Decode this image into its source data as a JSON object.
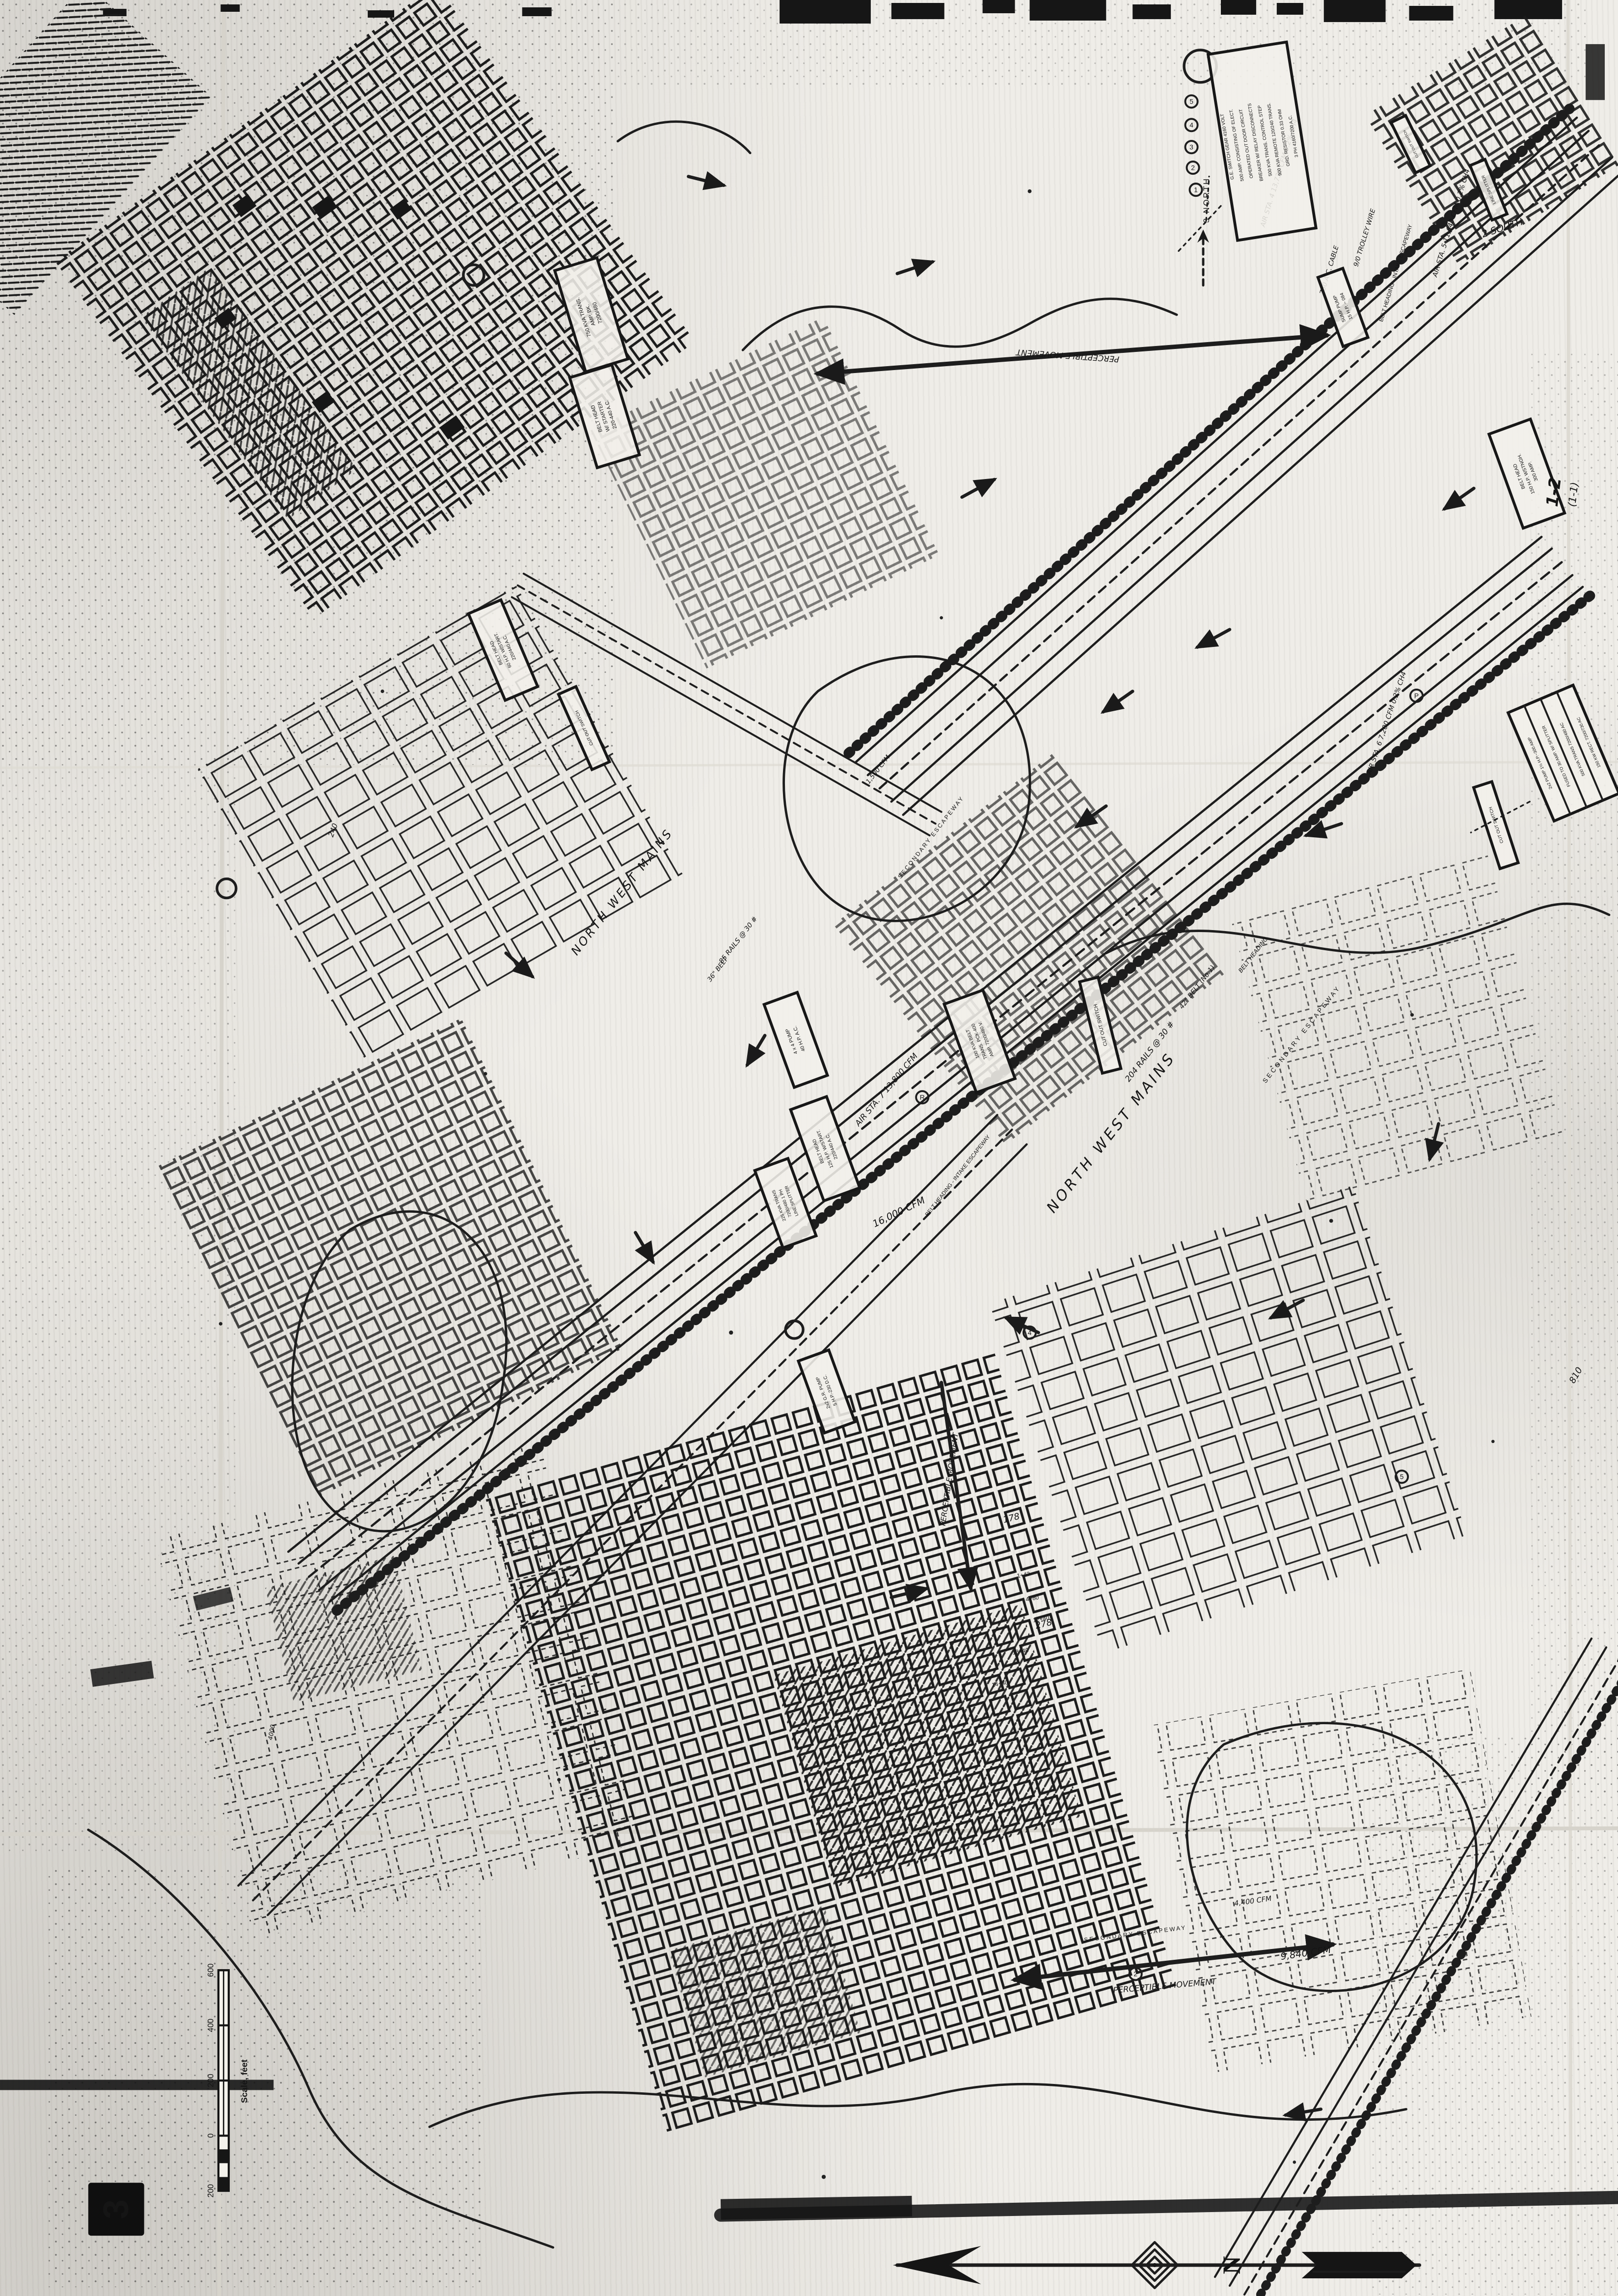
{
  "figure": {
    "number": "3"
  },
  "page_ref": {
    "line1": "1-2",
    "line2": "(1-1)"
  },
  "scale_bar": {
    "title": "Scale, feet",
    "ticks": [
      "200",
      "0",
      "200",
      "400",
      "600"
    ]
  },
  "compass": {
    "north": "N"
  },
  "labels": [
    {
      "text": "NORTH WEST MAINS"
    },
    {
      "text": "NORTH WEST MAINS"
    },
    {
      "text": "204 RAILS @ 30 #"
    },
    {
      "text": "85 RAILS @ 30 #"
    },
    {
      "text": "42\" BELT (No.1)"
    },
    {
      "text": "36\" BELT"
    },
    {
      "text": "BELT HEADING"
    },
    {
      "text": "SECONDARY ESCAPEWAY"
    },
    {
      "text": "SECONDARY ESCAPEWAY"
    },
    {
      "text": "SECONDARY ESCAPEWAY"
    },
    {
      "text": "BELT HEADING - INTAKE ESCAPEWAY"
    },
    {
      "text": "BELT HEADING - INTAKE ESCAPEWAY"
    },
    {
      "text": "9/0 TROLLEY WIRE"
    },
    {
      "text": "750 A.C. CABLE"
    },
    {
      "text": "AIR STA. 5   11,640 CFM   0.2% CH4"
    },
    {
      "text": "AIR STA. 4   13,732 CFM   0.2% CH4"
    },
    {
      "text": "AIR STA. 6   7,200 CFM   0.2% CH4"
    },
    {
      "text": "AIR STA. 7   13,800 CFM"
    },
    {
      "text": "PERCEPTIBLE MOVEMENT"
    },
    {
      "text": "PERCEPTIBLE MOVEMENT"
    },
    {
      "text": "PERCEPTIBLE MOVEMENT"
    },
    {
      "text": "9,840 CFM"
    },
    {
      "text": "16,000 CFM"
    },
    {
      "text": "4,400 CFM"
    },
    {
      "text": "1,500 CFM"
    },
    {
      "text": "2 SOUTH"
    },
    {
      "text": "3 NORTH"
    },
    {
      "text": "178"
    },
    {
      "text": "278"
    },
    {
      "text": "240"
    },
    {
      "text": "810"
    },
    {
      "text": "12+40"
    },
    {
      "text": "13+40"
    },
    {
      "text": "14+40"
    },
    {
      "text": "4+80"
    },
    {
      "text": "1+43"
    },
    {
      "text": "4000"
    }
  ],
  "boxes": [
    {
      "lines": [
        "G.E. SWITCH GEAR 4160 VOLT",
        "500 AMP. CONSISTING OF ELECT.",
        "OPERATED OUT DOOR CIRCUIT",
        "BREAKER W/ RELAY DISCONNECTS",
        "500 KVA TRANS. CONTROL STEP",
        "900 KVA REMOTE 120/240 TRANS.",
        "GRD. RESISTOR 0.33 OHM",
        "3 PH 4160/7200 A.C."
      ]
    },
    {
      "lines": [
        "750 KVA TRANS.",
        "AMP. BK.",
        "7200/480"
      ]
    },
    {
      "lines": [
        "BELT HEAD",
        "W/ STARTER",
        "220-440 A.C."
      ]
    },
    {
      "lines": [
        "BELT HEAD",
        "150 H.P. WSTNGH.",
        "300 AMP."
      ]
    },
    {
      "lines": [
        "CUT OUT SWITCH"
      ]
    },
    {
      "lines": [
        "CUT OUT SWITCH"
      ]
    },
    {
      "lines": [
        "CUT OUT SWITCH"
      ]
    },
    {
      "lines": [
        "CUT OUT SWITCH"
      ]
    },
    {
      "lines": [
        "LINE SPLITTER"
      ]
    },
    {
      "lines": [
        "4 x 4 PUMP",
        "40 H.P. A.C."
      ]
    },
    {
      "lines": [
        "BELT HEAD",
        "125 H.P. W/START.",
        "220/440 A.C."
      ]
    },
    {
      "lines": [
        "100 KVA BELT",
        "TRANS. PCK-400",
        "AMP. 7200/480 V."
      ]
    },
    {
      "lines": [
        "225 KVA TRANS",
        "7200/480 1 PH",
        "LINE SPLITTER"
      ]
    },
    {
      "lines": [
        "2x2 G.R. PUMP",
        "5 H.P.-230 D.C."
      ]
    },
    {
      "lines": [
        "BELT HEAD",
        "60 H.P. W/START.",
        "220/440 A.C."
      ]
    },
    {
      "lines": [
        "2x2 PUMP 1½ H.P.~300 AMP",
        "FUSED TO 30 AMP.  W/ SPLITTER",
        "500 KVA TRANS 7200/480 AC",
        "150 KW RECT. 7200/730 AC"
      ]
    },
    {
      "lines": [
        "SUMP PUMP",
        "15 H.P. ~ 084"
      ]
    }
  ],
  "markers": [
    "5",
    "4",
    "3",
    "2",
    "1",
    "2",
    "5",
    "4",
    "P",
    "R"
  ]
}
